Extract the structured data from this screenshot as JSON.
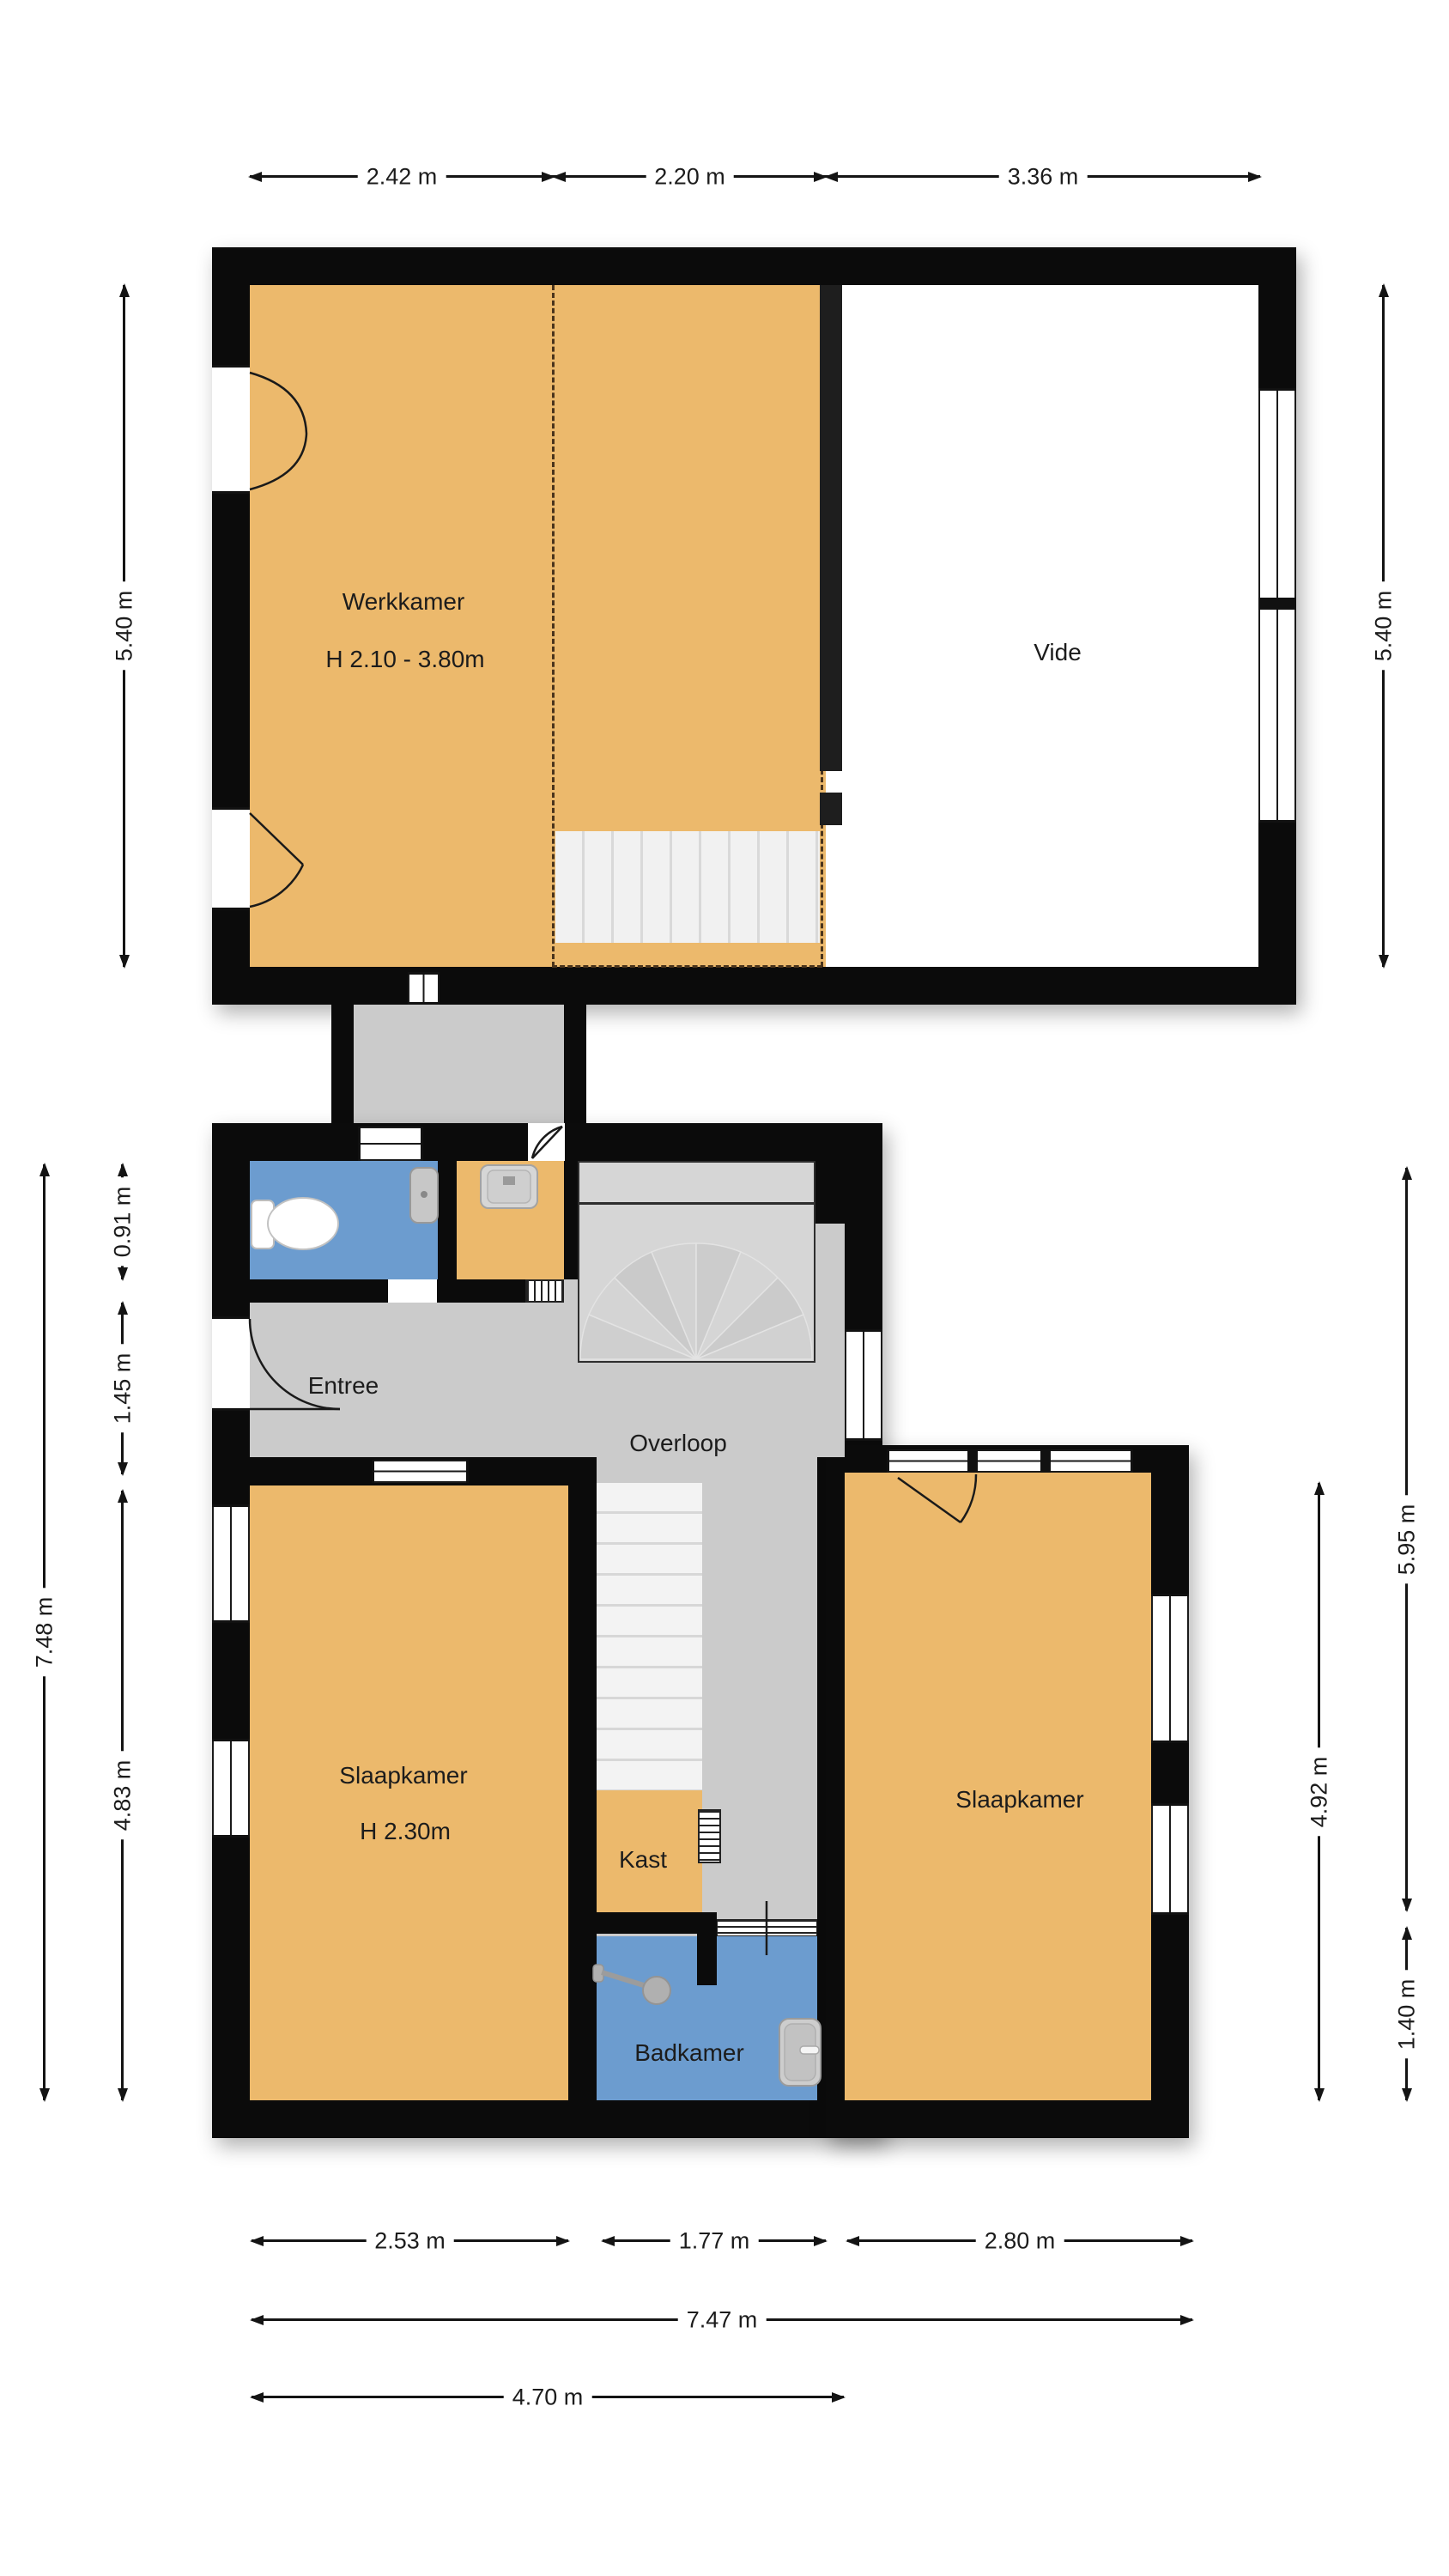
{
  "rooms": {
    "werkkamer": {
      "label": "Werkkamer",
      "height_label": "H 2.10 - 3.80m"
    },
    "vide": {
      "label": "Vide"
    },
    "entree": {
      "label": "Entree"
    },
    "overloop": {
      "label": "Overloop"
    },
    "slaapkamer_left": {
      "label": "Slaapkamer",
      "height_label": "H 2.30m"
    },
    "slaapkamer_right": {
      "label": "Slaapkamer"
    },
    "kast": {
      "label": "Kast"
    },
    "badkamer": {
      "label": "Badkamer"
    }
  },
  "dims": {
    "top": [
      "2.42 m",
      "2.20 m",
      "3.36 m"
    ],
    "upper_left": "5.40 m",
    "upper_right": "5.40 m",
    "lower_left": [
      "0.91 m",
      "1.45 m",
      "4.83 m",
      "7.48 m"
    ],
    "lower_right": [
      "5.95 m",
      "4.92 m",
      "1.40 m"
    ],
    "bottom": [
      "2.53 m",
      "1.77 m",
      "2.80 m",
      "7.47 m",
      "4.70 m"
    ]
  },
  "colors": {
    "room_orange": "#ECB96C",
    "wet_room_blue": "#6C9CCF",
    "hall_gray": "#CBCBCB",
    "wall_black": "#0B0B0B",
    "dash_brown": "#4A341C"
  }
}
